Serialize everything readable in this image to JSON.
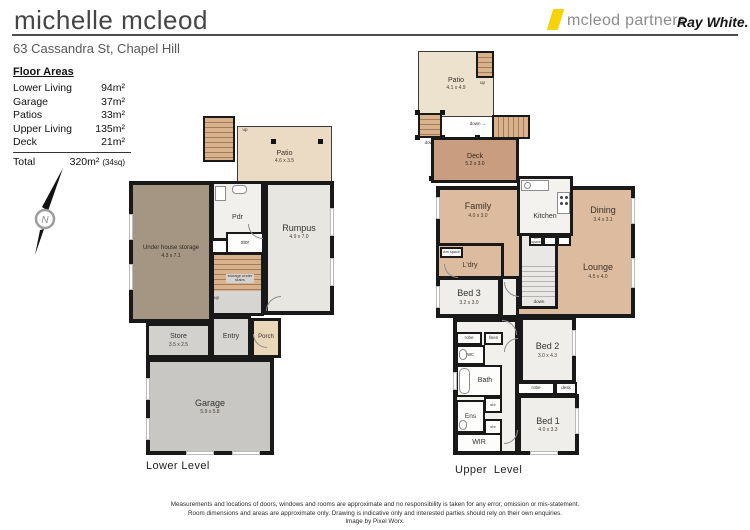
{
  "header": {
    "agent_name": "michelle mcleod",
    "brand": "mcleod partners",
    "brand2": "Ray White.",
    "address": "63 Cassandra St, Chapel Hill"
  },
  "floor_areas": {
    "title": "Floor Areas",
    "rows": [
      {
        "label": "Lower Living",
        "value": "94m²"
      },
      {
        "label": "Garage",
        "value": "37m²"
      },
      {
        "label": "Patios",
        "value": "33m²"
      },
      {
        "label": "Upper Living",
        "value": "135m²"
      },
      {
        "label": "Deck",
        "value": "21m²"
      }
    ],
    "total_label": "Total",
    "total_value": "320m²",
    "total_note": "(34sq)"
  },
  "compass": {
    "label": "N"
  },
  "lower_level": {
    "caption": "Lower Level",
    "patio": {
      "name": "Patio",
      "dims": "4.6 x 3.5"
    },
    "storage": {
      "name": "Under house storage",
      "dims": "4.3 x 7.1"
    },
    "pdr": {
      "name": "Pdr"
    },
    "stor": {
      "name": "stor"
    },
    "rumpus": {
      "name": "Rumpus",
      "dims": "4.9 x 7.0"
    },
    "stairs_note": "storage under stairs",
    "up_top": "up",
    "up_mid": "up",
    "store": {
      "name": "Store",
      "dims": "3.5 x 2.5"
    },
    "entry": {
      "name": "Entry"
    },
    "porch": {
      "name": "Porch"
    },
    "garage": {
      "name": "Garage",
      "dims": "5.9 x 5.8"
    }
  },
  "upper_level": {
    "caption": "Upper  Level",
    "patio": {
      "name": "Patio",
      "dims": "4.1 x 4.9"
    },
    "up_label": "up",
    "down_left": "down",
    "down_mid": "down →",
    "stairs_down": "down",
    "deck": {
      "name": "Deck",
      "dims": "5.2 x 3.0"
    },
    "family": {
      "name": "Family",
      "dims": "4.0 x 3.0"
    },
    "kitchen": {
      "name": "Kitchen"
    },
    "dining": {
      "name": "Dining",
      "dims": "3.4 x 3.1"
    },
    "ldry": {
      "name": "L'dry"
    },
    "wm_space": "wm space",
    "ref_space": "ref space",
    "lounge": {
      "name": "Lounge",
      "dims": "4.5 x 4.0"
    },
    "bed3": {
      "name": "Bed 3",
      "dims": "3.2 x 3.0"
    },
    "bed2": {
      "name": "Bed 2",
      "dims": "3.0 x 4.3"
    },
    "bed1": {
      "name": "Bed 1",
      "dims": "4.0 x 3.3"
    },
    "wc": "wc",
    "bath": "Bath",
    "ens": "Ens",
    "wir": "WIR",
    "robe": "robe",
    "linen": "linen",
    "shr": "shr",
    "desk": "desk"
  },
  "footer": {
    "line1": "Measurements and locations of doors, windows and rooms are approximate and no responsibility is taken for any error, omission or mis-statement.",
    "line2": "Room dimensions and areas are approximate only.  Drawing is indicative only and interested parties should rely on their own enquiries.",
    "line3": "Image by Pixel Worx."
  }
}
